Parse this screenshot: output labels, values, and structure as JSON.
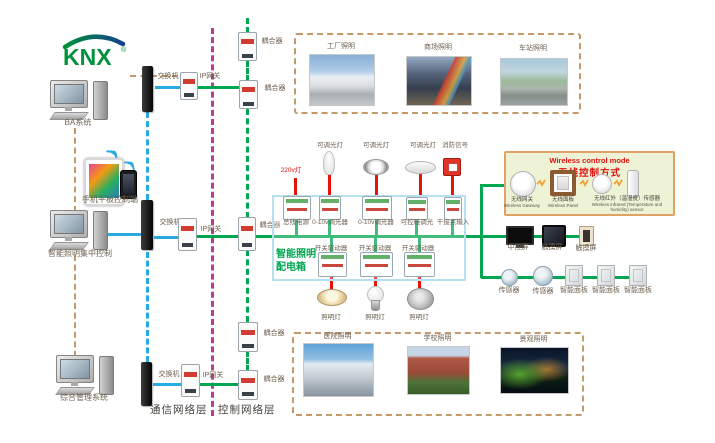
{
  "logo": {
    "text": "KNX"
  },
  "layers": {
    "communication": "通信网络层",
    "control": "控制网络层"
  },
  "left": {
    "ba_system": "BA系统",
    "mobile_control": "手机平板控制端",
    "central_control": "智能照明集中控制",
    "management_system": "综合管理系统"
  },
  "network": {
    "switch": "交换机",
    "ip_gateway": "IP网关",
    "coupler": "耦合器"
  },
  "scenes_top": [
    {
      "label": "工厂照明"
    },
    {
      "label": "商场照明"
    },
    {
      "label": "车站照明"
    }
  ],
  "scenes_bottom": [
    {
      "label": "医院照明"
    },
    {
      "label": "学校照明"
    },
    {
      "label": "景观照明"
    }
  ],
  "box": {
    "title_line1": "智能照明",
    "title_line2": "配电箱",
    "input_label": "220v灯",
    "top_devices": [
      "可调光灯",
      "可调光灯",
      "可调光灯",
      "消防信号"
    ],
    "modules_row1": [
      "总线电源",
      "0-10v调光器",
      "0-10v调光器",
      "可控硅调光",
      "干接点输入"
    ],
    "modules_row2": [
      "开关驱动器",
      "开关驱动器",
      "开关驱动器"
    ],
    "lamps": [
      "照明灯",
      "照明灯",
      "照明灯"
    ]
  },
  "wireless": {
    "title_en": "Wireless control mode",
    "title_zh": "无线控制方式",
    "items": [
      {
        "zh": "无线网关",
        "en": "Wireless Gateway"
      },
      {
        "zh": "无线面板",
        "en": "Wireless Panel"
      },
      {
        "zh": "无线红外（温湿度）传感器",
        "en": "Wireless infrared (Temperature and humidity) sensor"
      }
    ]
  },
  "right": {
    "central_screen": "中控屏",
    "touch_screen1": "触摸屏",
    "touch_screen2": "触摸屏",
    "sensor1": "传感器",
    "sensor2": "传感器",
    "panel1": "智能面板",
    "panel2": "智能面板",
    "panel3": "智能面板"
  },
  "colors": {
    "bus_green": "#00a651",
    "network_blue": "#29abe2",
    "separator_purple": "#bb3b8e",
    "link_tan": "#c49a6b",
    "signal_red": "#e8120c"
  }
}
